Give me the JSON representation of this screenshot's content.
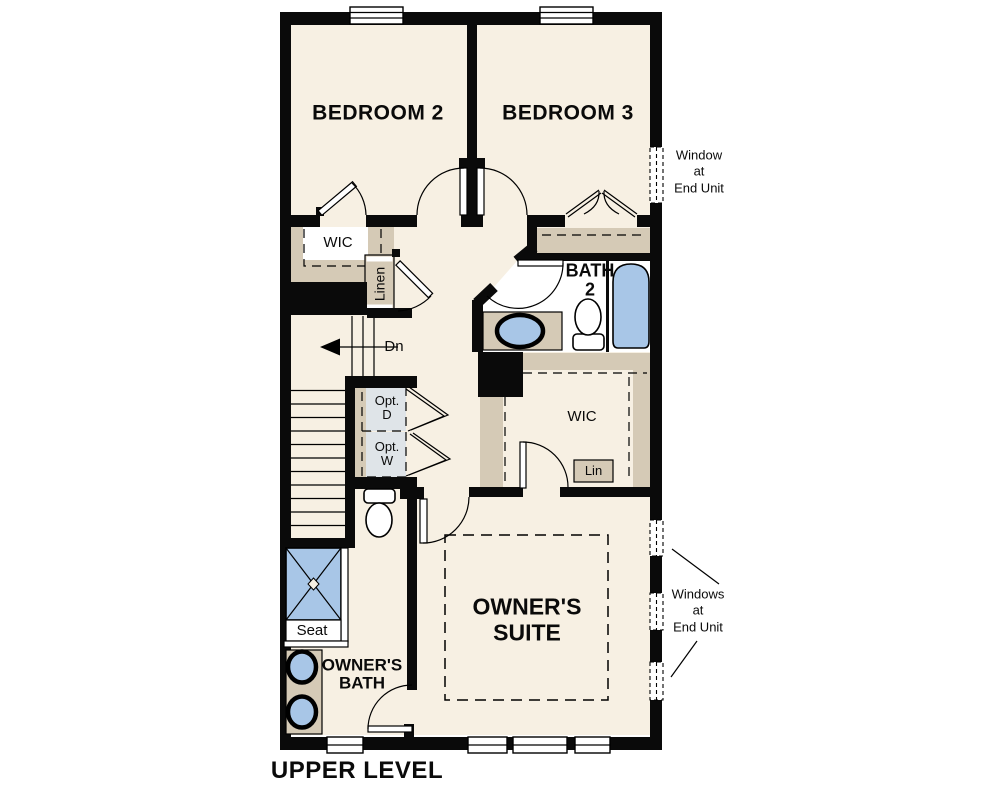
{
  "title": "UPPER LEVEL",
  "colors": {
    "floor": "#f7f0e3",
    "bath_floor": "#ffffff",
    "wall": "#0a0a0a",
    "shelf": "#d5cab6",
    "fixture": "#a8c6e7",
    "appliance": "#dfe4e8"
  },
  "labels": {
    "bedroom2": "BEDROOM 2",
    "bedroom3": "BEDROOM 3",
    "wic2": "WIC",
    "linen": "Linen",
    "bath2_line1": "BATH",
    "bath2_line2": "2",
    "dn": "Dn",
    "opt_d_line1": "Opt.",
    "opt_d_line2": "D",
    "opt_w_line1": "Opt.",
    "opt_w_line2": "W",
    "owners_wic": "WIC",
    "lin": "Lin",
    "suite_line1": "OWNER'S",
    "suite_line2": "SUITE",
    "seat": "Seat",
    "owners_bath_line1": "OWNER'S",
    "owners_bath_line2": "BATH"
  },
  "annotations": {
    "window_note_line1": "Window",
    "window_note_line2": "at",
    "window_note_line3": "End Unit",
    "windows_note_line1": "Windows",
    "windows_note_line2": "at",
    "windows_note_line3": "End Unit"
  }
}
